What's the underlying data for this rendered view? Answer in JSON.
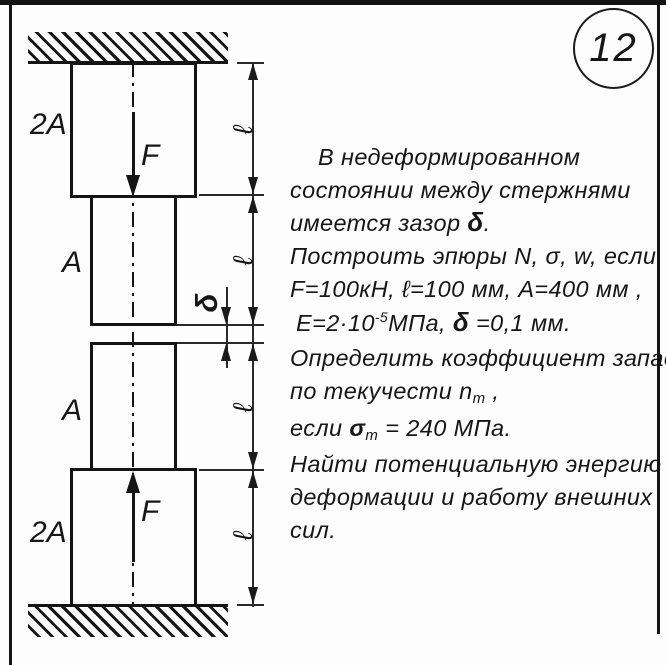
{
  "badge": {
    "number": "12"
  },
  "diagram": {
    "section_top_wide": "2A",
    "section_upper_narrow": "A",
    "section_lower_narrow": "A",
    "section_bottom_wide": "2A",
    "force_top": "F",
    "force_bottom": "F",
    "length_label": "ℓ",
    "gap_label": "δ"
  },
  "problem": {
    "l1": "В недеформированном",
    "l2": "состоянии  между стержнями",
    "l3a": "имеется зазор ",
    "l3b": "δ",
    "l3c": ".",
    "l4": "Построить эпюры N, σ, w, если",
    "l5": "F=100кН, ℓ=100 мм, А=400 мм ,",
    "l6a": "Е=2·10",
    "l6b": "-5",
    "l6c": "МПа, ",
    "l6d": "δ",
    "l6e": " =0,1 мм.",
    "l7": "Определить коэффициент запаса",
    "l8a": "по текучести n",
    "l8b": "т",
    "l8c": " ,",
    "l9a": "если ",
    "l9b": "σ",
    "l9c": "т",
    "l9d": " = 240 МПа.",
    "l10": "Найти потенциальную энергию",
    "l11": "деформации и работу внешних",
    "l12": "сил."
  }
}
